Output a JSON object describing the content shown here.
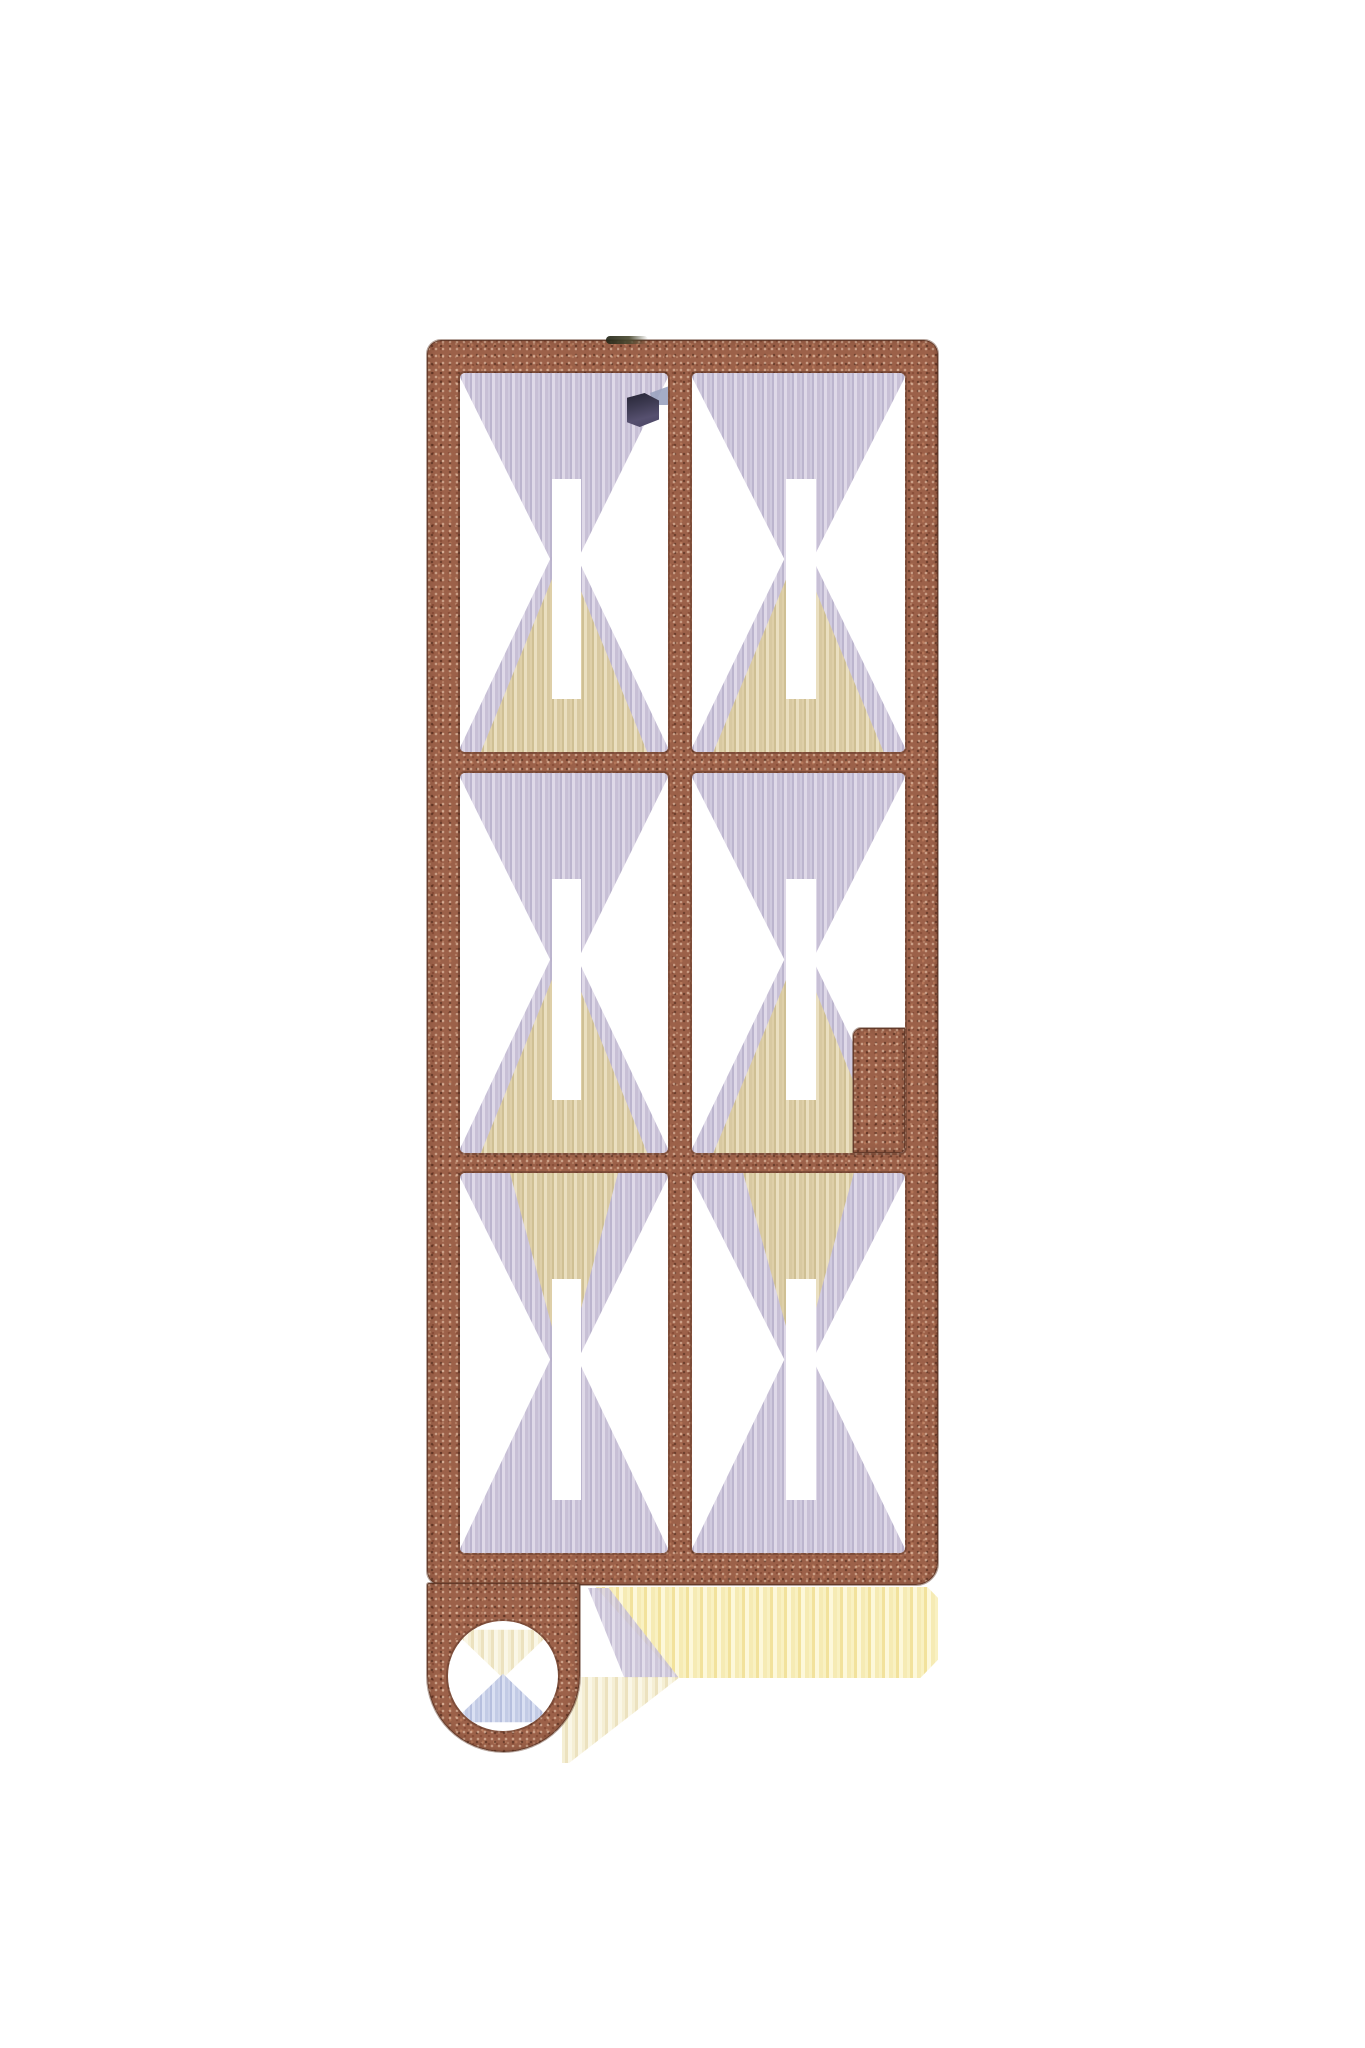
{
  "image": {
    "kind": "product-photo",
    "background_color": "#ffffff",
    "subject": "copper-colored speckle-textured flat frame blank (2x3 grid) with keychain tab and round hole"
  },
  "object": {
    "name": "copper grid frame keychain blank",
    "finish": "speckled hammered copper",
    "grid": {
      "columns": 2,
      "rows": 3,
      "openings": 6
    },
    "features": [
      "rectangular outer frame",
      "center vertical mullion",
      "two horizontal dividers",
      "solid step notch in lower-right of middle-right opening",
      "bottom-left tab with round keychain hole"
    ]
  },
  "colors": {
    "copper_base": "#9c6149",
    "copper_dark_speckle": "#5f3422",
    "copper_light_speckle": "#e8cdb9",
    "edge_outline": "#5d3a29",
    "artifact_lavender": "#c7c0d7",
    "artifact_tan": "#d9c9a0",
    "artifact_yellow": "#f7ecb4",
    "artifact_cream": "#f4eed6",
    "artifact_blue": "#bcc5e2",
    "artifact_indigo": "#4b4765",
    "artifact_dark_smudge": "#30321f",
    "background": "#ffffff"
  }
}
